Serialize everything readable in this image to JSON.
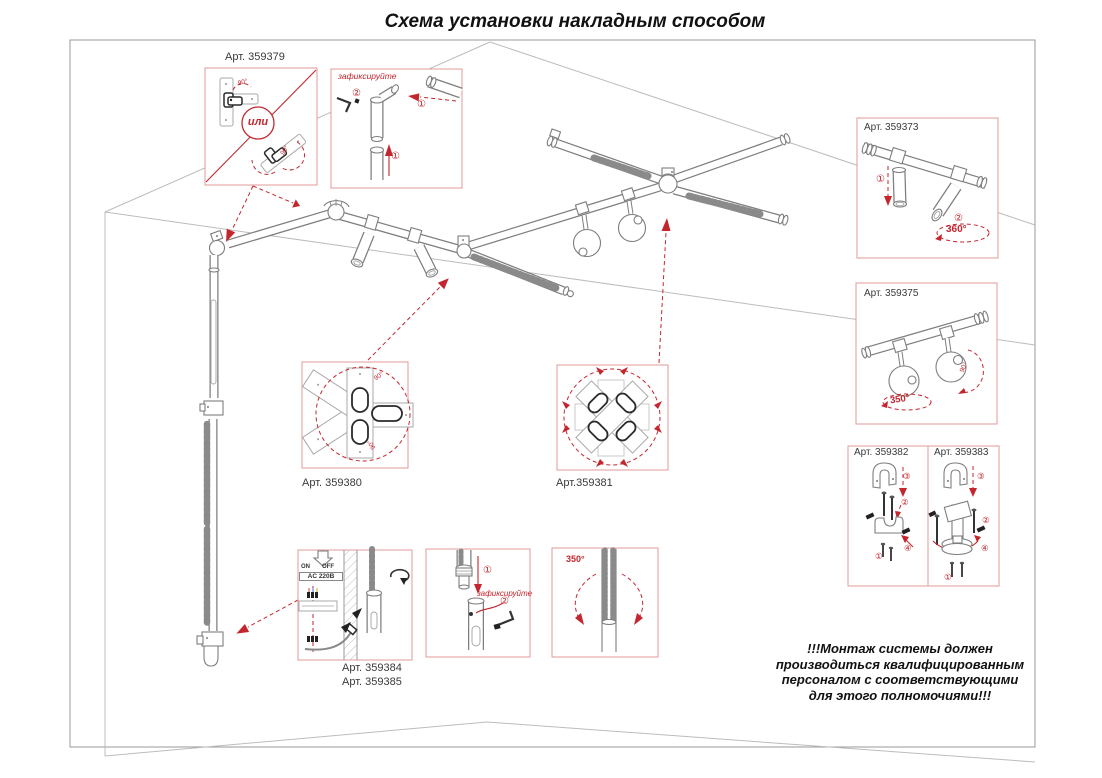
{
  "title": "Схема установки накладным способом",
  "warning": "!!!Монтаж системы должен\nпроизводиться квалифицированным\nперсоналом с соответствующими\nдля этого полномочиями!!!",
  "labels": {
    "art379": "Арт. 359379",
    "art373": "Арт. 359373",
    "art375": "Арт. 359375",
    "art382": "Арт. 359382",
    "art383": "Арт. 359383",
    "art380": "Арт. 359380",
    "art381": "Арт.359381",
    "art384": "Арт. 359384",
    "art385": "Арт. 359385"
  },
  "annotations": {
    "or": "или",
    "fix": "зафиксируйте",
    "deg360": "360°",
    "deg350": "350°",
    "deg90": "90°",
    "n1": "①",
    "n2": "②",
    "n3": "③",
    "n4": "④",
    "on": "ON",
    "off": "OFF",
    "ac": "AC 220В"
  }
}
